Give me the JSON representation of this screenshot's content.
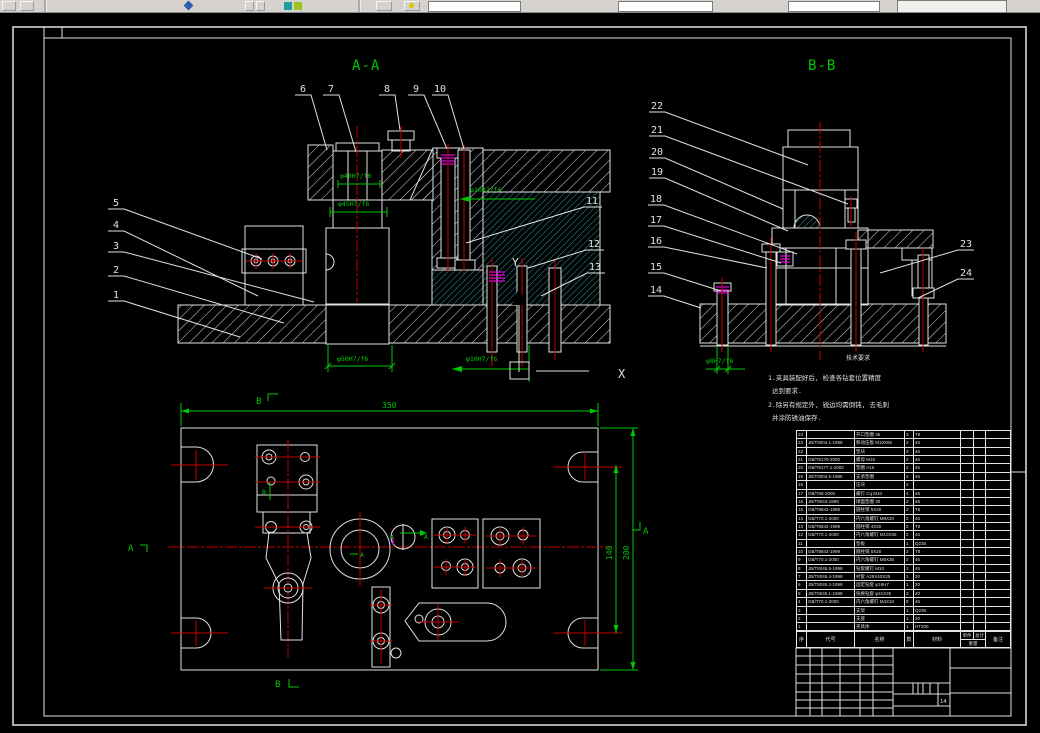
{
  "titles": {
    "section_a": "A-A",
    "section_b": "B-B"
  },
  "axes": {
    "x": "X",
    "y": "Y"
  },
  "labels": {
    "b_top": "B",
    "b_bottom": "B",
    "a_left": "A",
    "a_right": "A",
    "a_mark1": "A",
    "a_mark2": "A",
    "a_mark3": "A",
    "b_mark": "B"
  },
  "callouts": {
    "aa_top": [
      "6",
      "7",
      "8",
      "9",
      "10"
    ],
    "aa_left": [
      "5",
      "4",
      "3",
      "2",
      "1"
    ],
    "aa_right": [
      "11",
      "12",
      "13"
    ],
    "bb_left": [
      "22",
      "21",
      "20",
      "19",
      "18",
      "17",
      "16",
      "15",
      "14"
    ],
    "bb_right": [
      "23",
      "24"
    ]
  },
  "dims": {
    "aa_bush_top": "φ40H7/f6",
    "aa_bush": "φ45H7/f6",
    "aa_base": "φ50H7/f6",
    "aa_side": "φ10H7/f6",
    "aa_bottom": "φ10H7/f6",
    "bb_pin": "φ8H7/f6",
    "plan_width": "350",
    "plan_span": "140",
    "plan_height": "200"
  },
  "notes": {
    "caption": "技术要求",
    "lines": [
      "1.夹具装配好后, 检查各钻套位置精度",
      "达到要求.",
      "2.除另有规定外, 锐边均需倒钝, 去毛刺",
      "并涂防锈油保存."
    ]
  },
  "bom": {
    "headers": {
      "no": "序号",
      "code": "代号",
      "name": "名称",
      "qty": "数量",
      "mat": "材料",
      "w_unit": "单件",
      "w_total": "总计",
      "w_label": "重量",
      "note": "备注"
    },
    "rows": [
      {
        "no": "24",
        "code": "",
        "name": "开口垫圈 35",
        "qty": "3",
        "mat": "T8"
      },
      {
        "no": "23",
        "code": "JB/T8004.1-1999",
        "name": "移动压板 M10X65",
        "qty": "2",
        "mat": "45"
      },
      {
        "no": "22",
        "code": "",
        "name": "垫块",
        "qty": "3",
        "mat": "45"
      },
      {
        "no": "21",
        "code": "GB/T6170-2000",
        "name": "螺母 M16",
        "qty": "2",
        "mat": "45"
      },
      {
        "no": "20",
        "code": "GB/T6177.1-2000",
        "name": "垫圈 A16",
        "qty": "2",
        "mat": "45"
      },
      {
        "no": "19",
        "code": "JB/T8004.5-1986",
        "name": "支承垫圈",
        "qty": "2",
        "mat": "45"
      },
      {
        "no": "18",
        "code": "",
        "name": "压块",
        "qty": "2",
        "mat": ""
      },
      {
        "no": "17",
        "code": "GB/T68-2000",
        "name": "螺钉 Cq M10",
        "qty": "4",
        "mat": "45"
      },
      {
        "no": "16",
        "code": "JB/T8044-1999",
        "name": "球面垫圈 30",
        "qty": "2",
        "mat": "45"
      },
      {
        "no": "15",
        "code": "GB/T8842-1999",
        "name": "圆柱销 5X30",
        "qty": "2",
        "mat": "T8"
      },
      {
        "no": "14",
        "code": "GB/T70.1-2000",
        "name": "内六角螺钉 M8X20",
        "qty": "2",
        "mat": "45"
      },
      {
        "no": "13",
        "code": "GB/T8842-1999",
        "name": "圆柱销 4X20",
        "qty": "2",
        "mat": "T8"
      },
      {
        "no": "12",
        "code": "GB/T70.1-2000",
        "name": "内六角螺钉 M10X35",
        "qty": "2",
        "mat": "45"
      },
      {
        "no": "11",
        "code": "",
        "name": "垫板",
        "qty": "1",
        "mat": "Q235"
      },
      {
        "no": "10",
        "code": "GB/T8842-1999",
        "name": "圆柱销 5X20",
        "qty": "2",
        "mat": "T8"
      },
      {
        "no": "9",
        "code": "GB/T70.1-2000",
        "name": "内六角螺钉 M6X35",
        "qty": "2",
        "mat": "45"
      },
      {
        "no": "8",
        "code": "JB/T8045.5-1999",
        "name": "钻套螺钉 M10",
        "qty": "1",
        "mat": "45"
      },
      {
        "no": "7",
        "code": "JB/T8045.4-1999",
        "name": "衬套 A25X40X25",
        "qty": "1",
        "mat": "20"
      },
      {
        "no": "6",
        "code": "JB/T8045.2-1999",
        "name": "固定钻套 φ18H7",
        "qty": "1",
        "mat": "20"
      },
      {
        "no": "5",
        "code": "JB/T8045.1-1999",
        "name": "快换钻套 φ21X35",
        "qty": "3",
        "mat": "20"
      },
      {
        "no": "4",
        "code": "GB/T70.1-2000",
        "name": "内六角螺钉 M4X10",
        "qty": "9",
        "mat": "45"
      },
      {
        "no": "3",
        "code": "",
        "name": "支架",
        "qty": "1",
        "mat": "Q235"
      },
      {
        "no": "2",
        "code": "",
        "name": "支座",
        "qty": "1",
        "mat": "20"
      },
      {
        "no": "1",
        "code": "",
        "name": "夹具体",
        "qty": "1",
        "mat": "HT200"
      }
    ]
  },
  "title_block": {
    "sheet_no": "14"
  }
}
